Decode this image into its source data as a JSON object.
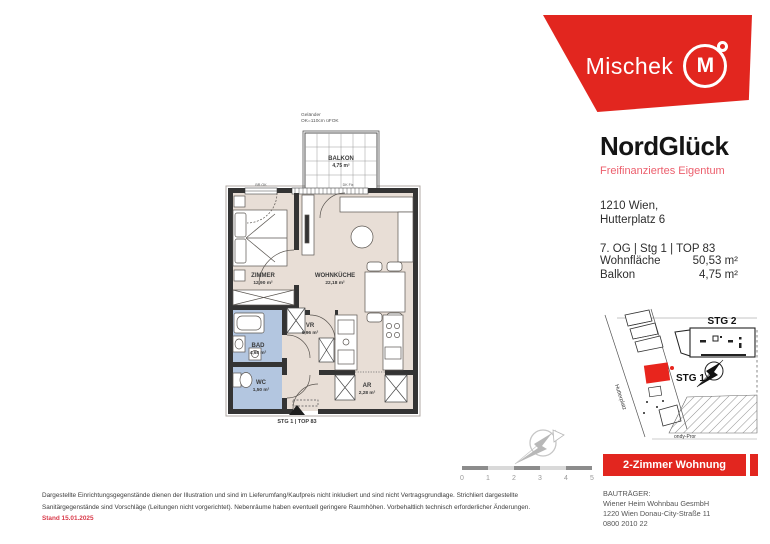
{
  "colors": {
    "brand_red": "#e2261f",
    "subtitle_pink": "#ec5f6d",
    "floor_beige": "#e8ded6",
    "bath_blue": "#b3c6e0",
    "wall_dark": "#343434",
    "stand_red": "#d93a4a"
  },
  "logo": {
    "brand": "Mischek",
    "monogram": "M"
  },
  "info": {
    "project": "NordGlück",
    "subtitle": "Freifinanziertes Eigentum",
    "address_line1": "1210 Wien,",
    "address_line2": "Hutterplatz 6",
    "unit_line": "7. OG | Stg 1 | TOP 83",
    "rows": [
      {
        "label": "Wohnfläche",
        "value": "50,53 m²"
      },
      {
        "label": "Balkon",
        "value": "4,75 m²"
      }
    ]
  },
  "floorplan": {
    "balcony_label": "BALKON",
    "balcony_area": "4,75 m²",
    "railing_note_1": "Geländer",
    "railing_note_2": "OK=110cm üFOK",
    "window_note_left": "BR.OK",
    "window_note_right": "DK Fix",
    "rooms": [
      {
        "label": "ZIMMER",
        "area": "12,90 m²"
      },
      {
        "label": "WOHNKÜCHE",
        "area": "22,18 m²"
      },
      {
        "label": "BAD",
        "area": "4,68 m²"
      },
      {
        "label": "WC",
        "area": "1,50 m²"
      },
      {
        "label": "VR",
        "area": "6,96 m²"
      },
      {
        "label": "AR",
        "area": "2,28 m²"
      }
    ],
    "entrance_label": "STG 1 | TOP 83"
  },
  "siteplan": {
    "stg1": "STG 1",
    "stg2": "STG 2",
    "street_left": "Hutterplatz",
    "street_bottom": "ondy-Pror"
  },
  "scalebar": {
    "ticks": [
      "0",
      "1",
      "2",
      "3",
      "4",
      "5"
    ]
  },
  "banner": {
    "label": "2-Zimmer Wohnung"
  },
  "developer": {
    "heading": "BAUTRÄGER:",
    "line1": "Wiener Heim Wohnbau GesmbH",
    "line2": "1220 Wien Donau-City-Straße 11",
    "line3": "0800 2010 22"
  },
  "disclaimer": {
    "line1": "Dargestellte Einrichtungsgegenstände dienen der Illustration und sind im Lieferumfang/Kaufpreis nicht inkludiert und sind nicht Vertragsgrundlage. Strichliert dargestellte",
    "line2": "Sanitärgegenstände sind Vorschläge (Leitungen nicht vorgerichtet). Nebenräume haben eventuell geringere Raumhöhen. Vorbehaltlich technisch erforderlicher Änderungen.",
    "stand": "Stand 15.01.2025"
  }
}
